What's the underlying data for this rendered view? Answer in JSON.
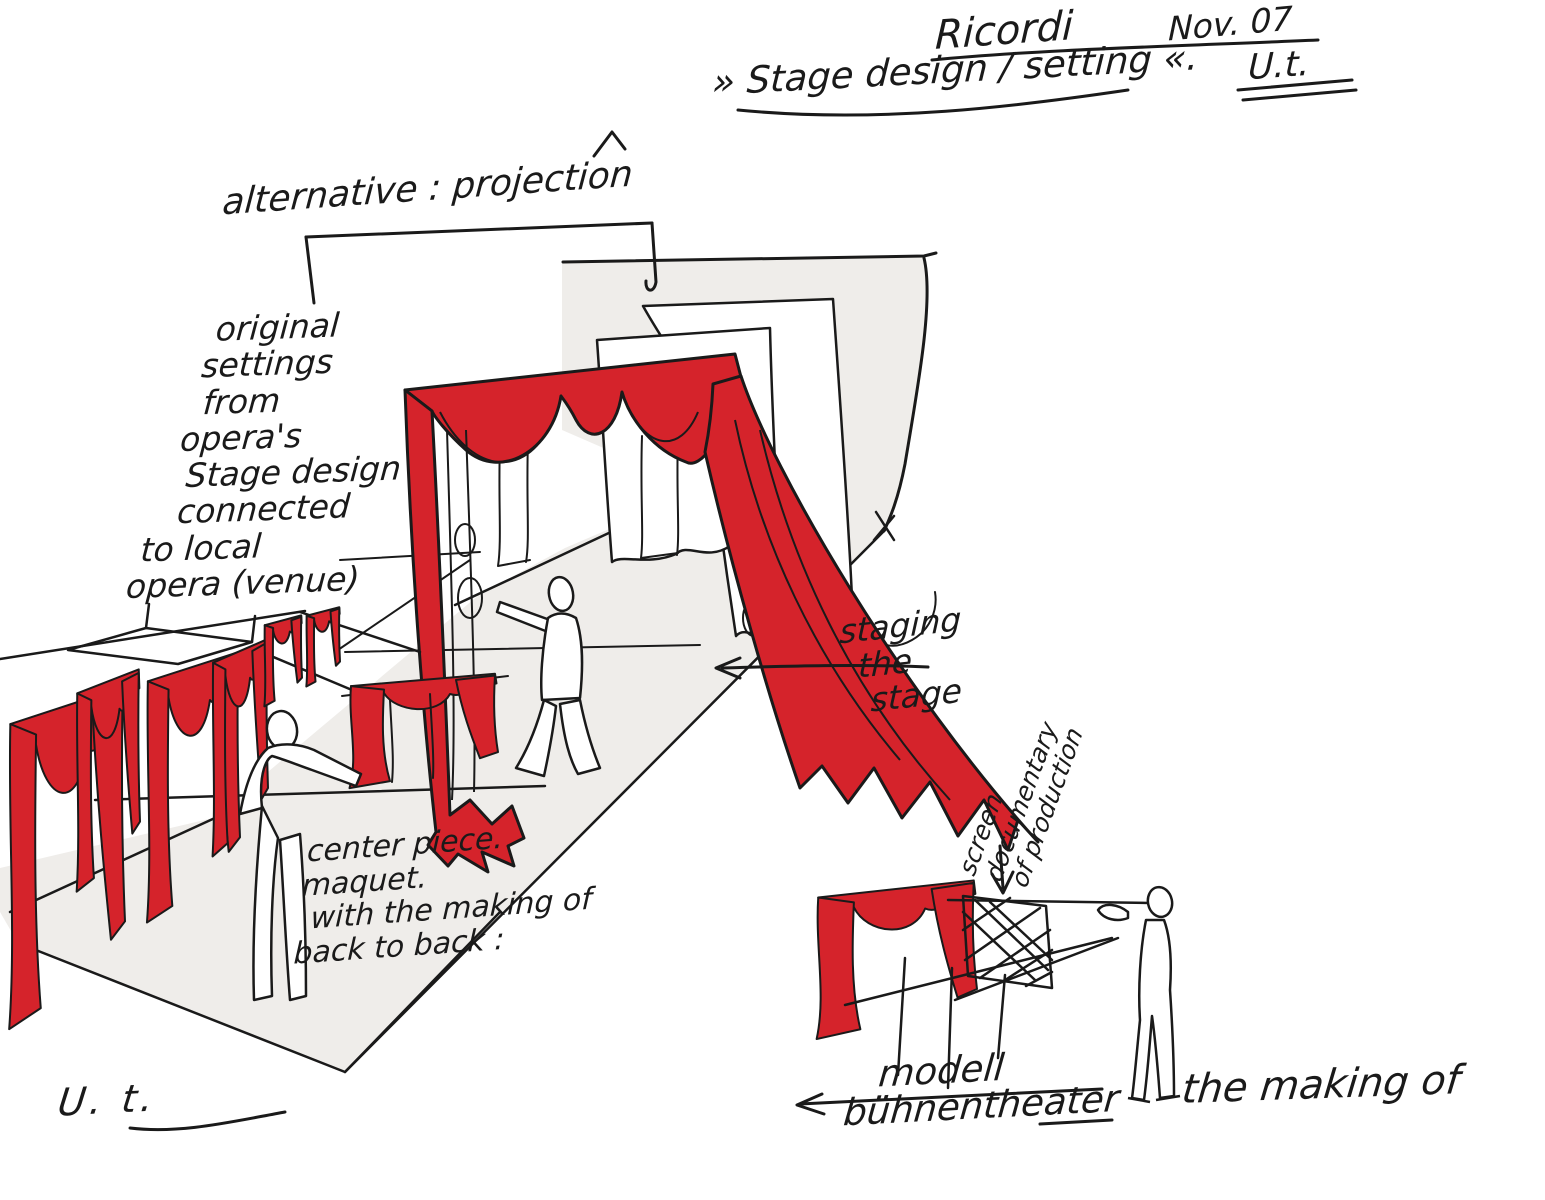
{
  "palette": {
    "curtain_red": "#d5232b",
    "ink": "#1a1a1a",
    "floor_gray": "#efedea",
    "paper": "#ffffff"
  },
  "header": {
    "project": "Ricordi",
    "date": "Nov. 07",
    "title": "» Stage design / setting «.",
    "signature": "U.t."
  },
  "annotations": {
    "alternative": "alternative : projection",
    "original_settings": {
      "lines": [
        "original",
        "settings",
        "from",
        "opera's",
        "Stage design",
        "connected",
        "to local",
        "opera (venue)"
      ]
    },
    "staging_the_stage": {
      "lines": [
        "staging",
        "the",
        "stage"
      ]
    },
    "center_piece": {
      "lines": [
        "center piece.",
        "maquet.",
        "with the making of",
        "back to back :"
      ]
    },
    "screen_documentary": {
      "lines": [
        "screen",
        "documentary",
        "of production"
      ]
    },
    "modell": {
      "lines": [
        "modell",
        "bühnentheater"
      ]
    },
    "the_making_of": "the making of",
    "artist_signature": "U. t."
  }
}
